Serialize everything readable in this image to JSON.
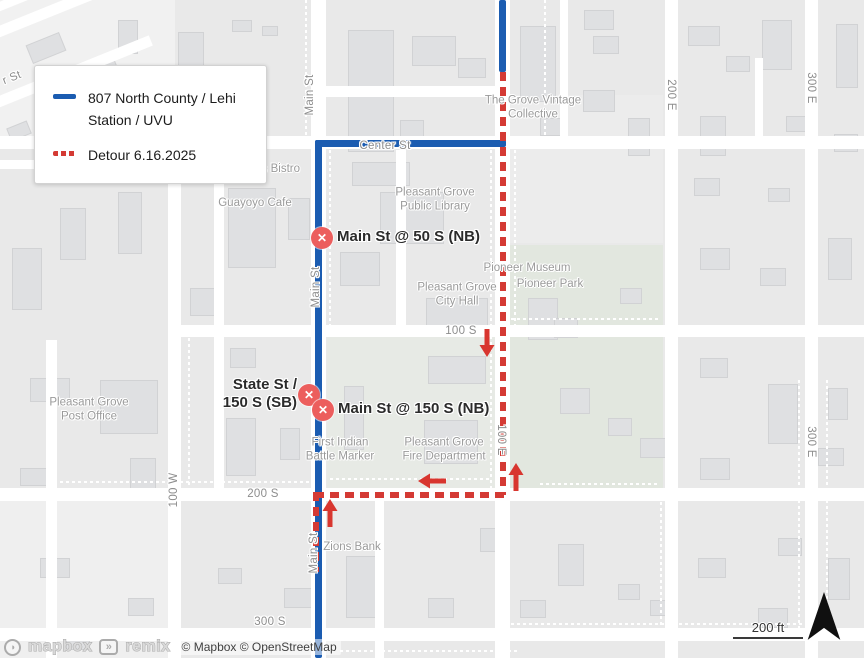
{
  "colors": {
    "route_blue": "#1b5cb1",
    "detour_red": "#d43a34",
    "arrow_red": "#d8362f",
    "marker_red": "#ec5e5d",
    "land": "#e9e9e9",
    "road": "#ffffff",
    "building": "#dfe0e2",
    "park_green": "#e2e7df",
    "poi_gray": "#9a9a9a",
    "street_gray": "#8d8d8d"
  },
  "legend": {
    "route_line1": "807 North County / Lehi",
    "route_line2": "Station / UVU",
    "detour_label": "Detour 6.16.2025"
  },
  "scale_bar": {
    "label": "200 ft"
  },
  "attribution": {
    "mapbox_wordmark": "mapbox",
    "remix_wordmark": "remix",
    "copyright": "© Mapbox © OpenStreetMap",
    "mapbox_icon": "mapbox-logo-icon",
    "remix_icon": "remix-logo-icon"
  },
  "north_arrow": "north-arrow",
  "closure_markers": [
    {
      "lines": [
        "Main St @ 50 S (NB)"
      ],
      "x": 322,
      "y": 238,
      "side": "right"
    },
    {
      "lines": [
        "State St /",
        "150 S (SB)"
      ],
      "x": 309,
      "y": 395,
      "side": "left"
    },
    {
      "lines": [
        "Main St @ 150 S (NB)"
      ],
      "x": 323,
      "y": 410,
      "side": "right"
    }
  ],
  "detour_arrows": [
    {
      "x": 487,
      "y": 343,
      "dir": "down"
    },
    {
      "x": 432,
      "y": 481,
      "dir": "left"
    },
    {
      "x": 516,
      "y": 477,
      "dir": "up"
    },
    {
      "x": 330,
      "y": 513,
      "dir": "up"
    }
  ],
  "street_labels": [
    {
      "text": "r St",
      "x": 12,
      "y": 78,
      "rot": -22
    },
    {
      "text": "Main St",
      "x": 310,
      "y": 95,
      "rot": -90
    },
    {
      "text": "Center St",
      "x": 385,
      "y": 146,
      "rot": 0
    },
    {
      "text": "Main St",
      "x": 316,
      "y": 287,
      "rot": -90
    },
    {
      "text": "Main St",
      "x": 314,
      "y": 553,
      "rot": -90
    },
    {
      "text": "100 W",
      "x": 174,
      "y": 490,
      "rot": -90
    },
    {
      "text": "100 E",
      "x": 501,
      "y": 440,
      "rot": 90
    },
    {
      "text": "200 E",
      "x": 671,
      "y": 95,
      "rot": 90
    },
    {
      "text": "300 E",
      "x": 811,
      "y": 88,
      "rot": 90
    },
    {
      "text": "300 E",
      "x": 811,
      "y": 442,
      "rot": 90
    },
    {
      "text": "100 S",
      "x": 461,
      "y": 331,
      "rot": 0
    },
    {
      "text": "200 S",
      "x": 263,
      "y": 494,
      "rot": 0
    },
    {
      "text": "300 S",
      "x": 270,
      "y": 622,
      "rot": 0
    }
  ],
  "poi_labels": [
    {
      "lines": [
        "CJ's"
      ],
      "x": 130,
      "y": 176
    },
    {
      "lines": [
        "Cravings Bistro"
      ],
      "x": 261,
      "y": 169
    },
    {
      "lines": [
        "Guayoyo Cafe"
      ],
      "x": 255,
      "y": 203
    },
    {
      "lines": [
        "The Grove Vintage",
        "Collective"
      ],
      "x": 533,
      "y": 108
    },
    {
      "lines": [
        "Pleasant Grove",
        "Public Library"
      ],
      "x": 435,
      "y": 200
    },
    {
      "lines": [
        "Pioneer Museum"
      ],
      "x": 527,
      "y": 268
    },
    {
      "lines": [
        "Pioneer Park"
      ],
      "x": 550,
      "y": 284
    },
    {
      "lines": [
        "Pleasant Grove",
        "City Hall"
      ],
      "x": 457,
      "y": 295
    },
    {
      "lines": [
        "Pleasant Grove",
        "Post Office"
      ],
      "x": 89,
      "y": 410
    },
    {
      "lines": [
        "First Indian",
        "Battle Marker"
      ],
      "x": 340,
      "y": 450
    },
    {
      "lines": [
        "Pleasant Grove",
        "Fire Department"
      ],
      "x": 444,
      "y": 450
    },
    {
      "lines": [
        "Zions Bank"
      ],
      "x": 352,
      "y": 547
    }
  ],
  "map": {
    "zones": [
      {
        "x": 0,
        "y": 0,
        "w": 175,
        "h": 145,
        "c": "#f1f1f1"
      },
      {
        "x": 0,
        "y": 500,
        "w": 168,
        "h": 158,
        "c": "#efefef"
      },
      {
        "x": 506,
        "y": 245,
        "w": 157,
        "h": 243,
        "c": "#e2e7df"
      },
      {
        "x": 327,
        "y": 333,
        "w": 168,
        "h": 155,
        "c": "#e7eae5"
      },
      {
        "x": 506,
        "y": 95,
        "w": 157,
        "h": 148,
        "c": "#ececec"
      }
    ],
    "roads_v": [
      {
        "x": 168,
        "y": 130,
        "w": 13,
        "h": 528
      },
      {
        "x": 311,
        "y": 0,
        "w": 15,
        "h": 658
      },
      {
        "x": 495,
        "y": 0,
        "w": 15,
        "h": 658
      },
      {
        "x": 665,
        "y": 0,
        "w": 13,
        "h": 658
      },
      {
        "x": 805,
        "y": 0,
        "w": 13,
        "h": 658
      },
      {
        "x": 46,
        "y": 340,
        "w": 11,
        "h": 318
      },
      {
        "x": 214,
        "y": 146,
        "w": 10,
        "h": 350
      },
      {
        "x": 396,
        "y": 150,
        "w": 10,
        "h": 182
      },
      {
        "x": 375,
        "y": 495,
        "w": 9,
        "h": 163
      },
      {
        "x": 560,
        "y": 0,
        "w": 8,
        "h": 140
      },
      {
        "x": 755,
        "y": 58,
        "w": 8,
        "h": 82
      }
    ],
    "roads_h": [
      {
        "x": 0,
        "y": 136,
        "w": 864,
        "h": 13
      },
      {
        "x": 318,
        "y": 86,
        "w": 187,
        "h": 11
      },
      {
        "x": 170,
        "y": 325,
        "w": 694,
        "h": 12
      },
      {
        "x": 0,
        "y": 488,
        "w": 864,
        "h": 13
      },
      {
        "x": 0,
        "y": 628,
        "w": 864,
        "h": 13
      },
      {
        "x": 0,
        "y": 160,
        "w": 170,
        "h": 9
      }
    ],
    "roads_diag": [
      {
        "x": -30,
        "y": 38,
        "w": 210,
        "h": 11,
        "r": -22
      },
      {
        "x": -30,
        "y": 108,
        "w": 195,
        "h": 11,
        "r": -22
      },
      {
        "x": -20,
        "y": 10,
        "w": 165,
        "h": 9,
        "r": -22
      }
    ],
    "dotted_v": [
      {
        "x": 305,
        "y": 0,
        "h": 136
      },
      {
        "x": 329,
        "y": 150,
        "h": 175
      },
      {
        "x": 490,
        "y": 150,
        "h": 338
      },
      {
        "x": 514,
        "y": 150,
        "h": 175
      },
      {
        "x": 660,
        "y": 490,
        "h": 138
      },
      {
        "x": 798,
        "y": 380,
        "h": 248
      },
      {
        "x": 826,
        "y": 380,
        "h": 248
      },
      {
        "x": 188,
        "y": 332,
        "h": 156
      },
      {
        "x": 544,
        "y": 0,
        "h": 136
      }
    ],
    "dotted_h": [
      {
        "x": 330,
        "y": 478,
        "w": 160
      },
      {
        "x": 540,
        "y": 483,
        "w": 120
      },
      {
        "x": 505,
        "y": 318,
        "w": 155
      },
      {
        "x": 60,
        "y": 481,
        "w": 250
      },
      {
        "x": 340,
        "y": 650,
        "w": 180
      },
      {
        "x": 505,
        "y": 623,
        "w": 330
      }
    ],
    "buildings": [
      [
        28,
        38,
        36,
        20,
        -22
      ],
      [
        88,
        58,
        28,
        16,
        -22
      ],
      [
        50,
        98,
        30,
        18,
        -22
      ],
      [
        8,
        124,
        22,
        14,
        -22
      ],
      [
        118,
        20,
        20,
        34
      ],
      [
        178,
        32,
        26,
        46
      ],
      [
        232,
        20,
        20,
        12
      ],
      [
        262,
        26,
        16,
        10
      ],
      [
        348,
        30,
        46,
        122
      ],
      [
        412,
        36,
        44,
        30
      ],
      [
        458,
        58,
        28,
        20
      ],
      [
        584,
        10,
        30,
        20
      ],
      [
        520,
        26,
        36,
        76
      ],
      [
        593,
        36,
        26,
        18
      ],
      [
        583,
        90,
        32,
        22
      ],
      [
        540,
        118,
        26,
        18
      ],
      [
        628,
        118,
        22,
        38
      ],
      [
        688,
        26,
        32,
        20
      ],
      [
        726,
        56,
        24,
        16
      ],
      [
        762,
        20,
        30,
        50
      ],
      [
        836,
        24,
        22,
        64
      ],
      [
        786,
        116,
        22,
        16
      ],
      [
        834,
        134,
        24,
        18
      ],
      [
        700,
        116,
        26,
        40
      ],
      [
        60,
        208,
        26,
        52
      ],
      [
        12,
        248,
        30,
        62
      ],
      [
        118,
        192,
        24,
        62
      ],
      [
        228,
        188,
        48,
        80
      ],
      [
        288,
        198,
        22,
        42
      ],
      [
        190,
        288,
        30,
        28
      ],
      [
        400,
        120,
        24,
        18
      ],
      [
        352,
        162,
        58,
        24
      ],
      [
        380,
        192,
        64,
        52
      ],
      [
        340,
        252,
        40,
        34
      ],
      [
        426,
        298,
        62,
        34
      ],
      [
        528,
        298,
        30,
        42
      ],
      [
        554,
        318,
        24,
        20
      ],
      [
        620,
        288,
        22,
        16
      ],
      [
        694,
        178,
        26,
        18
      ],
      [
        768,
        188,
        22,
        14
      ],
      [
        700,
        248,
        30,
        22
      ],
      [
        760,
        268,
        26,
        18
      ],
      [
        828,
        238,
        24,
        42
      ],
      [
        30,
        378,
        40,
        24
      ],
      [
        100,
        380,
        58,
        54
      ],
      [
        20,
        468,
        28,
        18
      ],
      [
        130,
        458,
        26,
        32
      ],
      [
        230,
        348,
        26,
        20
      ],
      [
        226,
        418,
        30,
        58
      ],
      [
        280,
        428,
        20,
        32
      ],
      [
        344,
        386,
        20,
        64
      ],
      [
        428,
        356,
        58,
        28
      ],
      [
        424,
        420,
        54,
        44
      ],
      [
        560,
        388,
        30,
        26
      ],
      [
        608,
        418,
        24,
        18
      ],
      [
        640,
        438,
        26,
        20
      ],
      [
        700,
        358,
        28,
        20
      ],
      [
        768,
        384,
        30,
        60
      ],
      [
        828,
        388,
        20,
        32
      ],
      [
        818,
        448,
        26,
        18
      ],
      [
        700,
        458,
        30,
        22
      ],
      [
        40,
        558,
        30,
        20
      ],
      [
        128,
        598,
        26,
        18
      ],
      [
        218,
        568,
        24,
        16
      ],
      [
        284,
        588,
        28,
        20
      ],
      [
        346,
        556,
        38,
        62
      ],
      [
        480,
        528,
        30,
        24
      ],
      [
        558,
        544,
        26,
        42
      ],
      [
        618,
        584,
        22,
        16
      ],
      [
        698,
        558,
        28,
        20
      ],
      [
        778,
        538,
        24,
        18
      ],
      [
        828,
        558,
        22,
        42
      ],
      [
        428,
        598,
        26,
        20
      ],
      [
        758,
        608,
        30,
        20
      ],
      [
        66,
        638,
        24,
        12
      ],
      [
        650,
        600,
        24,
        16
      ],
      [
        520,
        600,
        26,
        18
      ]
    ],
    "route_blue": [
      {
        "x": 499,
        "y": 0,
        "w": 7,
        "h": 72
      },
      {
        "x": 315,
        "y": 140,
        "w": 191,
        "h": 7
      },
      {
        "x": 315,
        "y": 140,
        "w": 7,
        "h": 518
      }
    ],
    "route_red_dash": [
      {
        "x": 500,
        "y": 72,
        "w": 6,
        "h": 423,
        "o": "v"
      },
      {
        "x": 315,
        "y": 492,
        "w": 191,
        "h": 6,
        "o": "h"
      },
      {
        "x": 313,
        "y": 492,
        "w": 6,
        "h": 80,
        "o": "v"
      }
    ]
  }
}
